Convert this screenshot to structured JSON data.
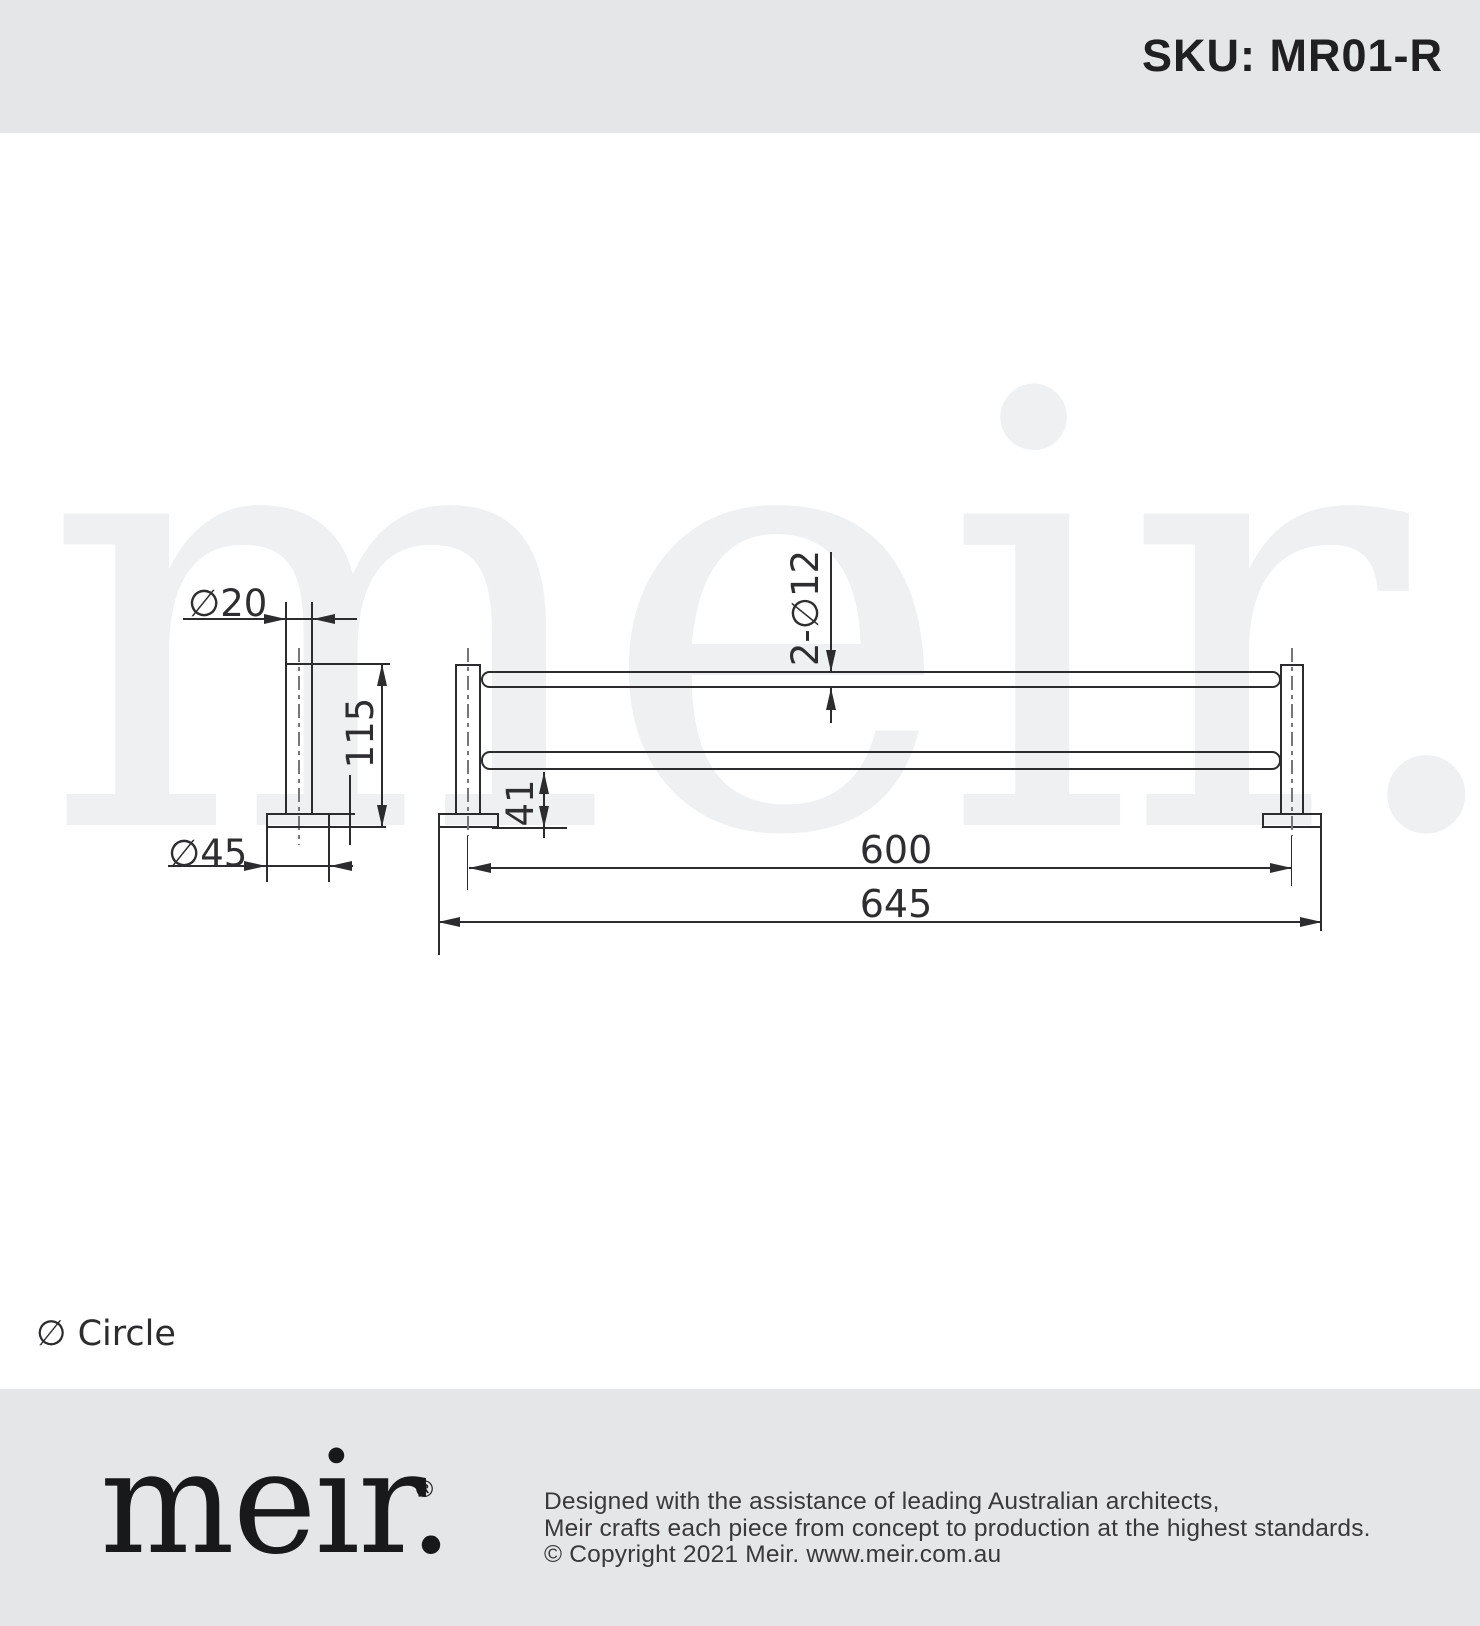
{
  "header": {
    "sku": "SKU: MR01-R"
  },
  "watermark": {
    "text": "meir."
  },
  "dimensions": {
    "post_diameter": "∅20",
    "base_diameter": "∅45",
    "post_height": "115",
    "rail_diameter": "2-∅12",
    "wall_offset": "41",
    "rail_length": "600",
    "overall_length": "645"
  },
  "legend": {
    "symbol_note": "∅ Circle"
  },
  "footer": {
    "logo": "meir.",
    "registered_mark": "®",
    "line1": "Designed with the assistance of leading Australian architects,",
    "line2": "Meir crafts each piece from concept to production at the highest standards.",
    "line3": "© Copyright 2021 Meir. www.meir.com.au"
  },
  "colors": {
    "band_gray": "#e5e6e8",
    "line_dark": "#2c2b2e",
    "watermark_gray": "#eff0f2"
  }
}
